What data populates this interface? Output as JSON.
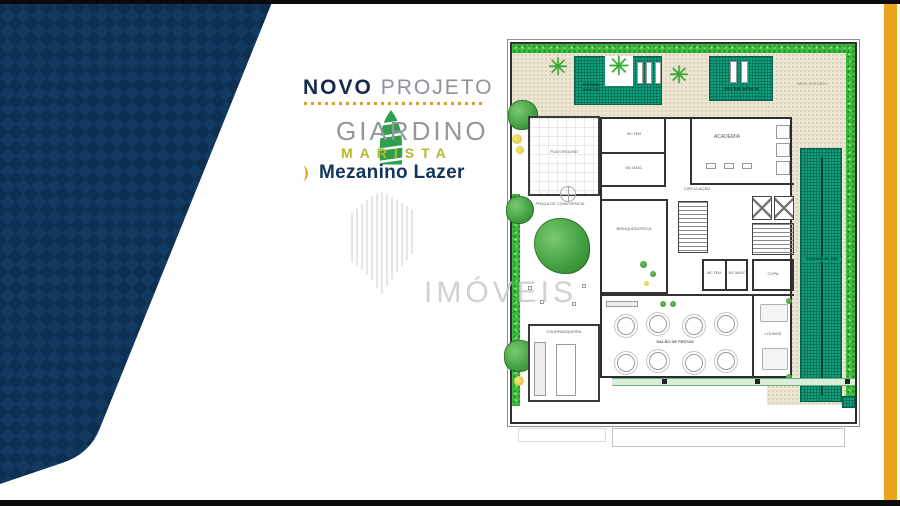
{
  "panel": {
    "kicker_bold": "NOVO",
    "kicker_light": "PROJETO",
    "brand_name": "GIARDINO",
    "brand_sub": "MARISTA",
    "floor_title": "Mezanino Lazer"
  },
  "page": {
    "watermark": "IMÓVEIS"
  },
  "plan": {
    "pools": {
      "adult": "PISCINA ADULTO",
      "kids": "PISCINA INFANTIL",
      "lap": "PISCINA DE 25M"
    },
    "outdoor": {
      "deck": "DECK ELEVADO",
      "playground": "PLAYGROUND",
      "praca": "PRAÇA DE CONVIVÊNCIA",
      "churrasqueira": "CHURRASQUEIRA"
    },
    "rooms": {
      "academia": "ACADEMIA",
      "circulacao": "CIRCULAÇÃO",
      "brinquedoteca": "BRINQUEDOTECA",
      "copa": "COPA",
      "wc_fem": "WC FEM",
      "wc_masc": "WC MASC",
      "salao": "SALÃO DE FESTAS",
      "lounge": "LOUNGE"
    }
  },
  "icons": {
    "palm": "✳"
  },
  "colors": {
    "navy": "#12395F",
    "gold": "#E9A41C",
    "pool_teal": "#0E9E7B",
    "grass_green": "#3CBB3C",
    "deck_beige": "#ECE5D2",
    "brand_green": "#2E9E4F",
    "brand_olive": "#B5B92A"
  }
}
